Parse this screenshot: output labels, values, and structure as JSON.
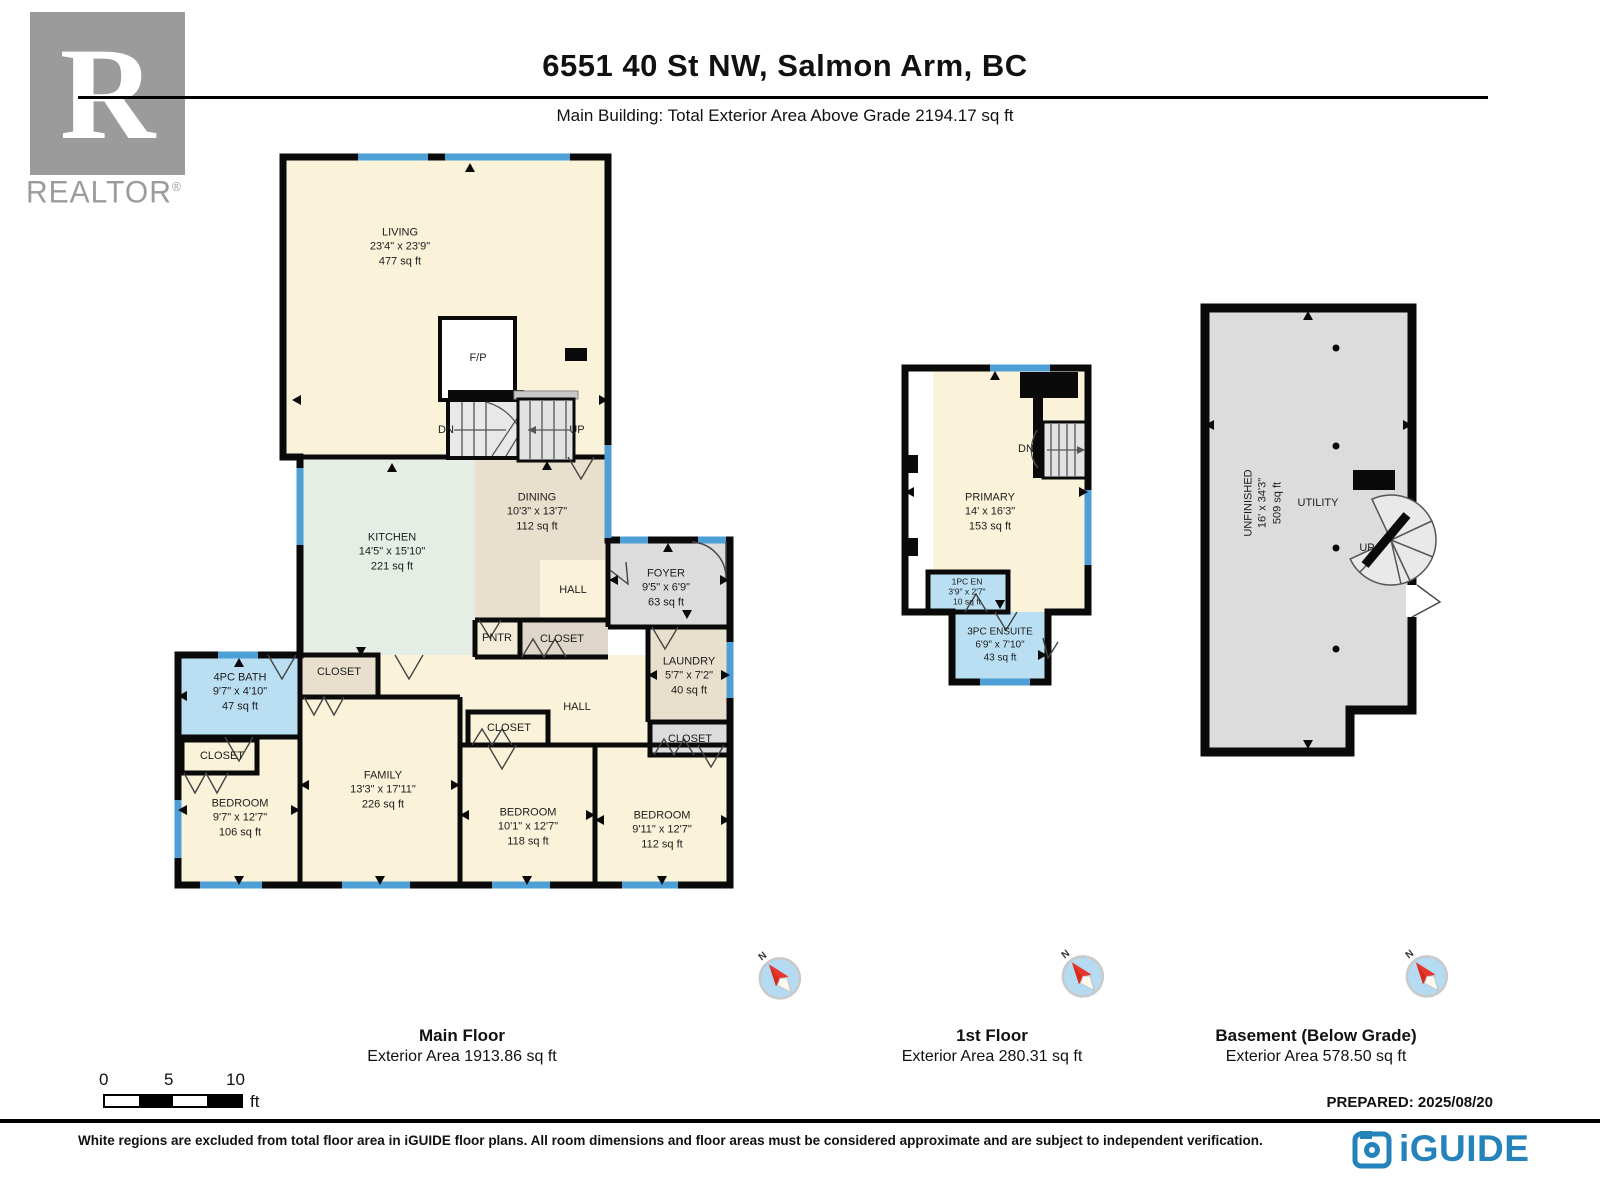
{
  "header": {
    "title": "6551 40 St NW, Salmon Arm, BC",
    "subtitle": "Main Building: Total Exterior Area Above Grade 2194.17 sq ft",
    "realtor_word": "REALTOR",
    "realtor_reg": "®",
    "realtor_r": "R"
  },
  "common": {
    "closet": "CLOSET",
    "hall": "HALL",
    "pantry": "PNTR",
    "up": "UP",
    "dn": "DN",
    "fp": "F/P",
    "north": "N"
  },
  "main_floor": {
    "title": "Main Floor",
    "area_line": "Exterior Area 1913.86 sq ft",
    "living": {
      "name": "LIVING",
      "dims": "23'4\" x 23'9\"",
      "area": "477 sq ft"
    },
    "kitchen": {
      "name": "KITCHEN",
      "dims": "14'5\" x 15'10\"",
      "area": "221 sq ft"
    },
    "dining": {
      "name": "DINING",
      "dims": "10'3\" x 13'7\"",
      "area": "112 sq ft"
    },
    "foyer": {
      "name": "FOYER",
      "dims": "9'5\" x 6'9\"",
      "area": "63 sq ft"
    },
    "laundry": {
      "name": "LAUNDRY",
      "dims": "5'7\" x 7'2\"",
      "area": "40 sq ft"
    },
    "bath": {
      "name": "4PC BATH",
      "dims": "9'7\" x 4'10\"",
      "area": "47 sq ft"
    },
    "family": {
      "name": "FAMILY",
      "dims": "13'3\" x 17'11\"",
      "area": "226 sq ft"
    },
    "bedroom_left": {
      "name": "BEDROOM",
      "dims": "9'7\" x 12'7\"",
      "area": "106 sq ft"
    },
    "bedroom_mid": {
      "name": "BEDROOM",
      "dims": "10'1\" x 12'7\"",
      "area": "118 sq ft"
    },
    "bedroom_right": {
      "name": "BEDROOM",
      "dims": "9'11\" x 12'7\"",
      "area": "112 sq ft"
    }
  },
  "first_floor": {
    "title": "1st Floor",
    "area_line": "Exterior Area 280.31 sq ft",
    "primary": {
      "name": "PRIMARY",
      "dims": "14' x 16'3\"",
      "area": "153 sq ft"
    },
    "en": {
      "name": "1PC EN",
      "dims": "3'9\" x 2'7\"",
      "area": "10 sq ft"
    },
    "ensuite": {
      "name": "3PC ENSUITE",
      "dims": "6'9\" x 7'10\"",
      "area": "43 sq ft"
    }
  },
  "basement": {
    "title": "Basement (Below Grade)",
    "area_line": "Exterior Area 578.50 sq ft",
    "unfinished": {
      "name": "UNFINISHED",
      "dims": "16' x 34'3\"",
      "area": "509 sq ft"
    },
    "utility": {
      "name": "UTILITY"
    }
  },
  "scale": {
    "tick0": "0",
    "tick5": "5",
    "tick10": "10",
    "unit": "ft"
  },
  "prepared": "PREPARED: 2025/08/20",
  "disclaimer": "White regions are excluded from total floor area in iGUIDE floor plans. All room dimensions and floor areas must be considered approximate and are subject to independent verification.",
  "brand": "iGUIDE",
  "colors": {
    "accent_blue": "#2583bb",
    "window_blue": "#4d9fd6",
    "bath_blue": "#badff3",
    "cream": "#faf3da",
    "kitchen_green": "#e4eee4",
    "tan": "#e8e0cd",
    "gray": "#dcdcdc"
  }
}
